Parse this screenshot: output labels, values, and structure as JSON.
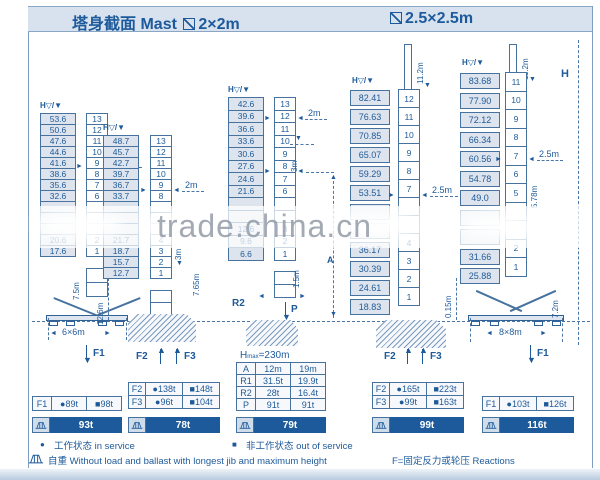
{
  "title": {
    "zh": "塔身截面",
    "en": "Mast",
    "left_size": "2×2m",
    "right_size": "2.5×2.5m"
  },
  "axis": {
    "header": "H▽/▼",
    "h_label": "H"
  },
  "watermark": "trade.china.cn",
  "icons": {
    "left": "◄",
    "right": "►",
    "up": "▲",
    "down": "▼"
  },
  "towers": [
    {
      "rows": [
        {
          "h": "53.6",
          "n": "13"
        },
        {
          "h": "50.6",
          "n": "12"
        },
        {
          "h": "47.6",
          "n": "11"
        },
        {
          "h": "44.6",
          "n": "10"
        },
        {
          "h": "41.6",
          "n": "9"
        },
        {
          "h": "38.6",
          "n": "8"
        },
        {
          "h": "35.6",
          "n": "7"
        },
        {
          "h": "32.6",
          "n": "6"
        },
        {
          "h": "",
          "n": ""
        },
        {
          "h": "",
          "n": ""
        },
        {
          "h": "",
          "n": ""
        },
        {
          "h": "20.6",
          "n": "2"
        },
        {
          "h": "17.6",
          "n": "1"
        }
      ],
      "dims": {
        "width": "2m",
        "height": "7.5m",
        "base": "6×6m"
      },
      "force": "F1"
    },
    {
      "rows": [
        {
          "h": "48.7",
          "n": "13"
        },
        {
          "h": "45.7",
          "n": "12"
        },
        {
          "h": "42.7",
          "n": "11"
        },
        {
          "h": "39.7",
          "n": "10"
        },
        {
          "h": "36.7",
          "n": "9"
        },
        {
          "h": "33.7",
          "n": "8"
        },
        {
          "h": "",
          "n": ""
        },
        {
          "h": "",
          "n": ""
        },
        {
          "h": "",
          "n": ""
        },
        {
          "h": "21.7",
          "n": "4"
        },
        {
          "h": "18.7",
          "n": "3"
        },
        {
          "h": "15.7",
          "n": "2"
        },
        {
          "h": "12.7",
          "n": "1"
        }
      ],
      "dims": {
        "width": "2m",
        "d3": "3m",
        "d765": "7.65m",
        "d126": "12.6m"
      },
      "forces": [
        "F2",
        "F3"
      ]
    },
    {
      "rows": [
        {
          "h": "42.6",
          "n": "13"
        },
        {
          "h": "39.6",
          "n": "12"
        },
        {
          "h": "36.6",
          "n": "11"
        },
        {
          "h": "33.6",
          "n": "10"
        },
        {
          "h": "30.6",
          "n": "9"
        },
        {
          "h": "27.6",
          "n": "8"
        },
        {
          "h": "24.6",
          "n": "7"
        },
        {
          "h": "21.6",
          "n": "6"
        },
        {
          "h": "",
          "n": ""
        },
        {
          "h": "",
          "n": ""
        },
        {
          "h": "12.6",
          "n": "3"
        },
        {
          "h": "9.6",
          "n": "2"
        },
        {
          "h": "6.6",
          "n": "1"
        }
      ],
      "dims": {
        "width": "2m",
        "d3": "3m",
        "a": "A",
        "d15": "1.5m"
      },
      "anchors": {
        "r2": "R2",
        "p": "P"
      },
      "hmax": {
        "pre": "H",
        "sub": "max",
        "post": "=230m"
      }
    },
    {
      "rows": [
        {
          "h": "82.41",
          "n": "12"
        },
        {
          "h": "76.63",
          "n": "11"
        },
        {
          "h": "70.85",
          "n": "10"
        },
        {
          "h": "65.07",
          "n": "9"
        },
        {
          "h": "59.29",
          "n": "8"
        },
        {
          "h": "53.51",
          "n": "7"
        },
        {
          "h": "",
          "n": ""
        },
        {
          "h": "",
          "n": ""
        },
        {
          "h": "36.17",
          "n": "4"
        },
        {
          "h": "30.39",
          "n": "3"
        },
        {
          "h": "24.61",
          "n": "2"
        },
        {
          "h": "18.83",
          "n": "1"
        }
      ],
      "dims": {
        "width": "2.5m",
        "top": "11.2m",
        "d015": "0.15m"
      },
      "forces": [
        "F2",
        "F3"
      ]
    },
    {
      "rows": [
        {
          "h": "83.68",
          "n": "11"
        },
        {
          "h": "77.90",
          "n": "10"
        },
        {
          "h": "72.12",
          "n": "9"
        },
        {
          "h": "66.34",
          "n": "8"
        },
        {
          "h": "60.56",
          "n": "7"
        },
        {
          "h": "54.78",
          "n": "6"
        },
        {
          "h": "49.0",
          "n": "5"
        },
        {
          "h": "",
          "n": ""
        },
        {
          "h": "",
          "n": ""
        },
        {
          "h": "31.66",
          "n": "2"
        },
        {
          "h": "25.88",
          "n": "1"
        }
      ],
      "dims": {
        "width": "2.5m",
        "top": "11.2m",
        "d578": "5.78m",
        "base": "8×8m",
        "d72": "7.2m"
      },
      "force": "F1"
    }
  ],
  "tables": [
    {
      "rows": [
        [
          "F1",
          "●89t",
          "■98t"
        ]
      ],
      "badge": "93t"
    },
    {
      "rows": [
        [
          "F2",
          "●138t",
          "■148t"
        ],
        [
          "F3",
          "●96t",
          "■104t"
        ]
      ],
      "badge": "78t"
    },
    {
      "rows": [
        [
          "A",
          "12m",
          "19m"
        ],
        [
          "R1",
          "31.5t",
          "19.9t"
        ],
        [
          "R2",
          "28t",
          "16.4t"
        ],
        [
          "P",
          "91t",
          "91t"
        ]
      ],
      "badge": "79t"
    },
    {
      "rows": [
        [
          "F2",
          "●165t",
          "■223t"
        ],
        [
          "F3",
          "●99t",
          "■163t"
        ]
      ],
      "badge": "99t"
    },
    {
      "rows": [
        [
          "F1",
          "●103t",
          "■126t"
        ]
      ],
      "badge": "116t"
    }
  ],
  "legend": {
    "in_mark": "●",
    "in_text": "工作状态 in service",
    "out_mark": "■",
    "out_text": "非工作状态 out of service",
    "weight_text": "自重 Without load and ballast with longest jib and maximum height",
    "reactions_text": "F=固定反力或轮压  Reactions"
  }
}
